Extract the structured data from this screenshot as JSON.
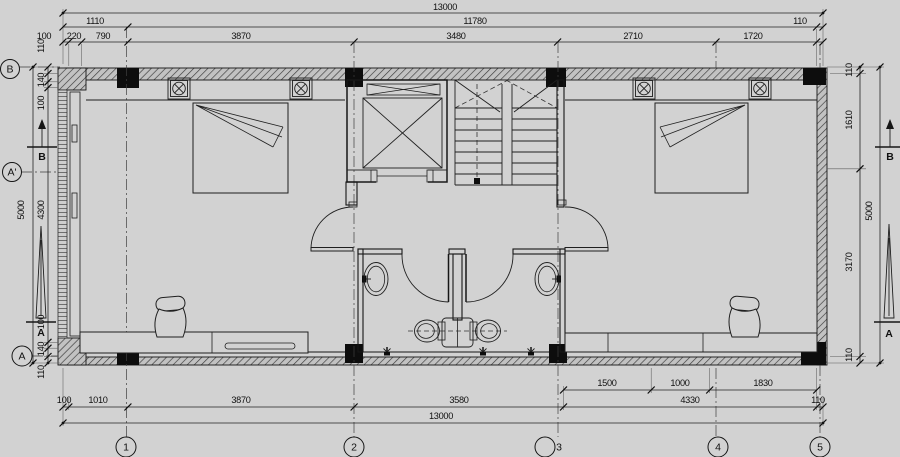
{
  "colors": {
    "background": "#d2d2d2",
    "line": "#1a1a1a",
    "wall_hatch_base": "#c2c2c2",
    "column_fill": "#0d0d0d"
  },
  "dim_top": {
    "total": "13000",
    "row2": [
      "1110",
      "11780",
      "110"
    ],
    "row3": [
      "100",
      "220",
      "790",
      "3870",
      "3480",
      "2710",
      "1720"
    ]
  },
  "dim_bottom": {
    "inner": [
      "1500",
      "1000",
      "1830"
    ],
    "mid": [
      "100",
      "1010",
      "3870",
      "3580",
      "4330",
      "110"
    ],
    "total": "13000"
  },
  "dim_left": {
    "total": "5000",
    "segments": [
      "110",
      "140",
      "100",
      "4300",
      "100",
      "140",
      "110"
    ]
  },
  "dim_right": {
    "total": "5000",
    "segments": [
      "110",
      "1610",
      "3170",
      "110"
    ]
  },
  "grid_bubbles_bottom": [
    "1",
    "2",
    "3",
    "4",
    "5"
  ],
  "grid_bubbles_left": [
    "B",
    "A'",
    "A"
  ],
  "section_markers": {
    "b": "B",
    "a": "A"
  }
}
